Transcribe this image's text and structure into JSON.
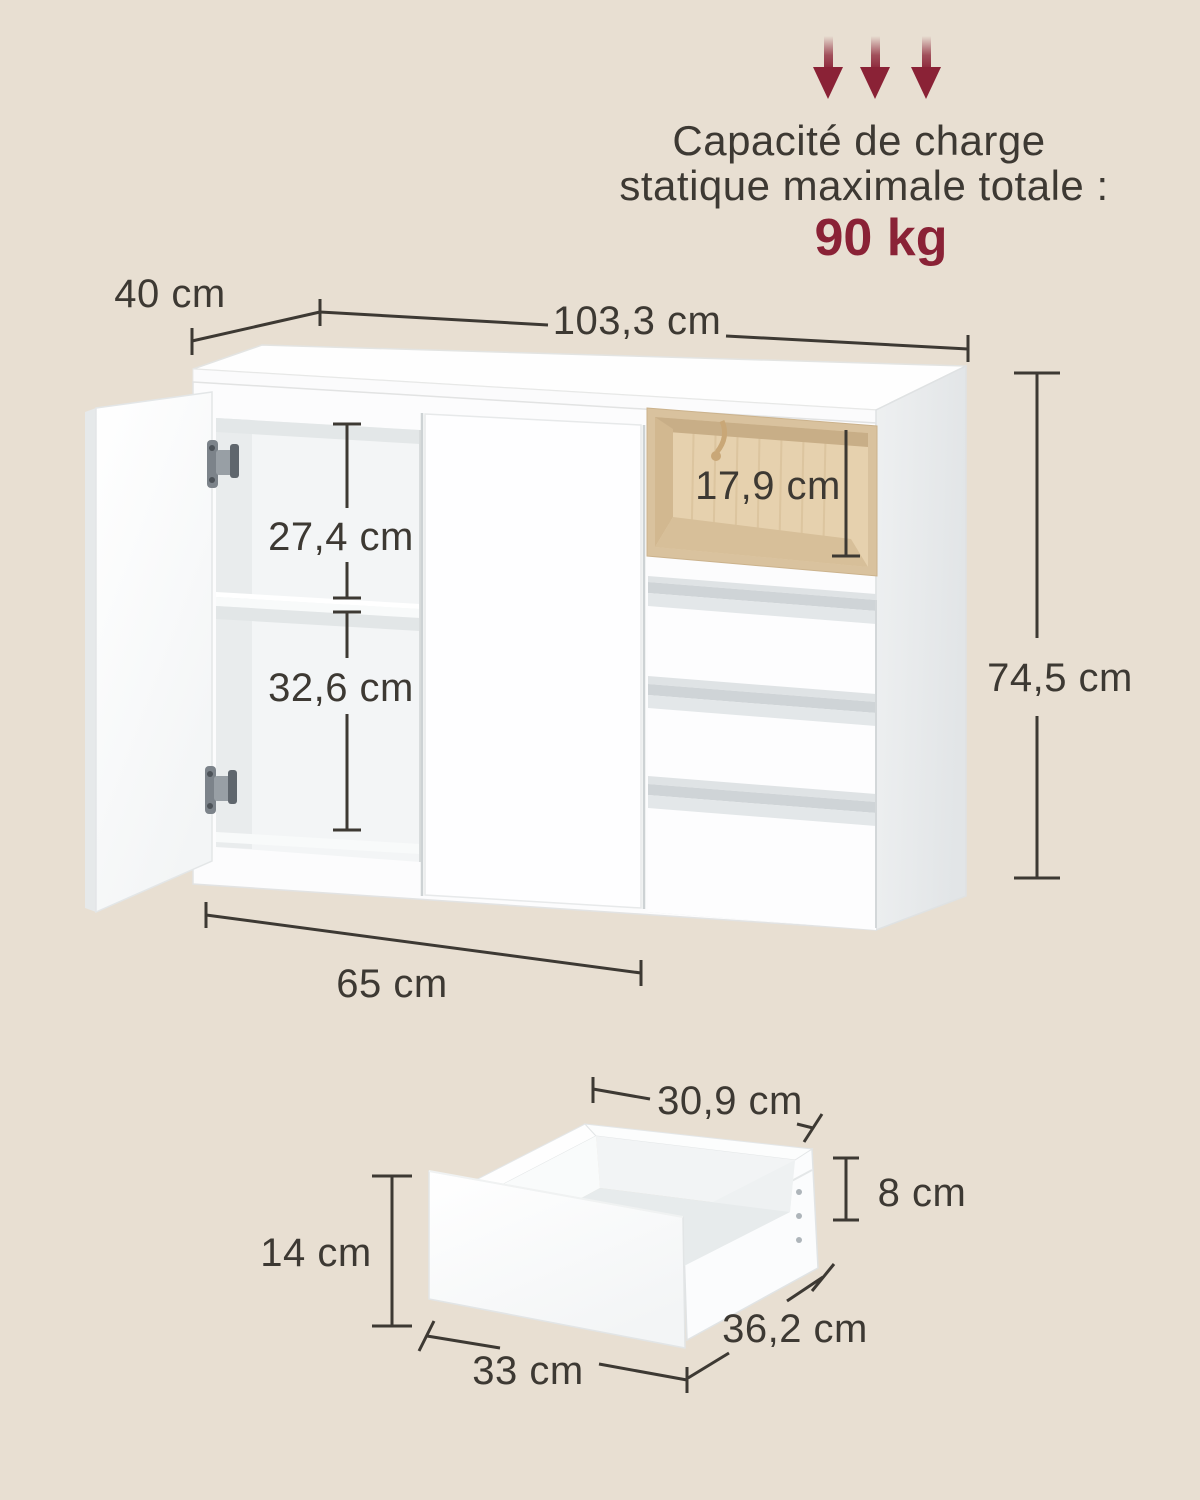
{
  "colors": {
    "background": "#e8dfd2",
    "line": "#3d3933",
    "accent_red": "#8a2236",
    "oak_wood": "#e6d1ae",
    "cabinet_white": "#fdfdfe",
    "side_panel_gray": "#e9ebec"
  },
  "capacity": {
    "line1": "Capacité de charge",
    "line2": "statique maximale totale :",
    "value": "90 kg"
  },
  "cabinet_dims": {
    "depth": "40 cm",
    "width": "103,3 cm",
    "height": "74,5 cm",
    "upper_compartment_height": "27,4 cm",
    "lower_compartment_height": "32,6 cm",
    "open_compartment_height": "17,9 cm",
    "door_section_width": "65 cm"
  },
  "drawer_dims": {
    "inner_width": "30,9 cm",
    "inner_height": "8 cm",
    "front_height": "14 cm",
    "front_width": "33 cm",
    "depth": "36,2 cm"
  }
}
